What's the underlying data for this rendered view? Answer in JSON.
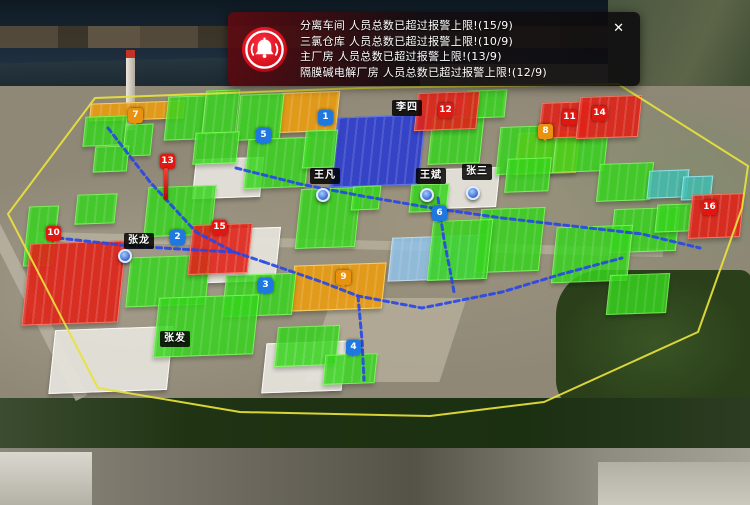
{
  "colors": {
    "building_green": "#35d41c",
    "building_green_border": "#7dff5a",
    "building_red": "#e02318",
    "building_red_border": "#ff7a66",
    "building_orange": "#e89b12",
    "building_orange_border": "#ffd36e",
    "building_darkblue": "#2336d6",
    "building_darkblue_border": "#5a74ff",
    "building_lightblue": "#8fc3ea",
    "building_lightblue_border": "#cfe8ff",
    "building_teal": "#3fbdb0",
    "building_teal_border": "#99eeff",
    "building_gray": "#e4e2da",
    "boundary_yellow": "#e8e23c",
    "route_blue": "#2746e8",
    "marker_blue": "#1f78e0",
    "marker_orange": "#e8920f",
    "marker_red": "#e01812",
    "alert_red": "#e01020"
  },
  "alert_panel": {
    "icon": "alarm-bell-icon",
    "close_label": "✕",
    "messages": [
      "分离车间 人员总数已超过报警上限!(15/9)",
      "三氯仓库 人员总数已超过报警上限!(10/9)",
      "主厂房 人员总数已超过报警上限!(13/9)",
      "隔膜碱电解厂房 人员总数已超过报警上限!(12/9)"
    ]
  },
  "map": {
    "boundary": {
      "points": "95,98 360,88 618,84 748,166 742,208 698,332 544,402 430,416 240,412 98,388 8,214"
    },
    "routes": [
      {
        "points": "108,128 150,182 196,232 234,252 264,262"
      },
      {
        "points": "58,238 130,246 196,250 234,252"
      },
      {
        "points": "236,168 300,184 362,196 432,208 502,218 572,226 642,234 700,248"
      },
      {
        "points": "438,198 444,240 450,270 454,292"
      },
      {
        "points": "264,262 322,282 358,296 422,308 502,292 562,274 622,258"
      },
      {
        "points": "358,296 362,340 364,380"
      }
    ],
    "buildings": [
      {
        "color": "orange",
        "x": 90,
        "y": 102,
        "w": 92,
        "h": 16
      },
      {
        "color": "orange",
        "x": 280,
        "y": 92,
        "w": 56,
        "h": 38
      },
      {
        "color": "orange",
        "x": 516,
        "y": 132,
        "w": 60,
        "h": 40
      },
      {
        "color": "orange",
        "x": 292,
        "y": 264,
        "w": 90,
        "h": 44
      },
      {
        "color": "darkblue",
        "x": 334,
        "y": 116,
        "w": 86,
        "h": 68
      },
      {
        "color": "lightblue",
        "x": 390,
        "y": 236,
        "w": 94,
        "h": 42
      },
      {
        "color": "gray",
        "x": 194,
        "y": 158,
        "w": 66,
        "h": 38
      },
      {
        "color": "gray",
        "x": 210,
        "y": 228,
        "w": 66,
        "h": 52
      },
      {
        "color": "gray",
        "x": 52,
        "y": 328,
        "w": 116,
        "h": 62
      },
      {
        "color": "gray",
        "x": 264,
        "y": 342,
        "w": 78,
        "h": 48
      },
      {
        "color": "gray",
        "x": 440,
        "y": 168,
        "w": 56,
        "h": 38
      },
      {
        "color": "green",
        "x": 84,
        "y": 116,
        "w": 40,
        "h": 28
      },
      {
        "color": "green",
        "x": 124,
        "y": 124,
        "w": 26,
        "h": 30
      },
      {
        "color": "green",
        "x": 166,
        "y": 96,
        "w": 36,
        "h": 42
      },
      {
        "color": "green",
        "x": 204,
        "y": 90,
        "w": 32,
        "h": 42
      },
      {
        "color": "green",
        "x": 238,
        "y": 94,
        "w": 42,
        "h": 44
      },
      {
        "color": "green",
        "x": 194,
        "y": 132,
        "w": 42,
        "h": 30
      },
      {
        "color": "green",
        "x": 246,
        "y": 138,
        "w": 60,
        "h": 48
      },
      {
        "color": "green",
        "x": 304,
        "y": 130,
        "w": 30,
        "h": 36
      },
      {
        "color": "green",
        "x": 430,
        "y": 116,
        "w": 50,
        "h": 46
      },
      {
        "color": "green",
        "x": 466,
        "y": 90,
        "w": 38,
        "h": 26
      },
      {
        "color": "green",
        "x": 498,
        "y": 126,
        "w": 56,
        "h": 46
      },
      {
        "color": "green",
        "x": 554,
        "y": 136,
        "w": 50,
        "h": 34
      },
      {
        "color": "green",
        "x": 598,
        "y": 163,
        "w": 52,
        "h": 36
      },
      {
        "color": "green",
        "x": 612,
        "y": 208,
        "w": 64,
        "h": 42
      },
      {
        "color": "green",
        "x": 554,
        "y": 226,
        "w": 74,
        "h": 54
      },
      {
        "color": "green",
        "x": 478,
        "y": 208,
        "w": 62,
        "h": 62
      },
      {
        "color": "green",
        "x": 430,
        "y": 220,
        "w": 58,
        "h": 58
      },
      {
        "color": "green",
        "x": 298,
        "y": 188,
        "w": 58,
        "h": 58
      },
      {
        "color": "green",
        "x": 146,
        "y": 186,
        "w": 66,
        "h": 48
      },
      {
        "color": "green",
        "x": 76,
        "y": 194,
        "w": 38,
        "h": 28
      },
      {
        "color": "green",
        "x": 26,
        "y": 206,
        "w": 28,
        "h": 58
      },
      {
        "color": "green",
        "x": 128,
        "y": 256,
        "w": 78,
        "h": 48
      },
      {
        "color": "green",
        "x": 224,
        "y": 274,
        "w": 68,
        "h": 40
      },
      {
        "color": "green",
        "x": 156,
        "y": 296,
        "w": 98,
        "h": 58
      },
      {
        "color": "green",
        "x": 276,
        "y": 326,
        "w": 60,
        "h": 38
      },
      {
        "color": "green",
        "x": 324,
        "y": 354,
        "w": 50,
        "h": 28
      },
      {
        "color": "green",
        "x": 608,
        "y": 274,
        "w": 58,
        "h": 38
      },
      {
        "color": "green",
        "x": 656,
        "y": 204,
        "w": 32,
        "h": 26
      },
      {
        "color": "green",
        "x": 506,
        "y": 158,
        "w": 42,
        "h": 32
      },
      {
        "color": "green",
        "x": 94,
        "y": 146,
        "w": 32,
        "h": 24
      },
      {
        "color": "green",
        "x": 352,
        "y": 186,
        "w": 26,
        "h": 22
      },
      {
        "color": "green",
        "x": 410,
        "y": 184,
        "w": 36,
        "h": 26
      },
      {
        "color": "teal",
        "x": 648,
        "y": 170,
        "w": 38,
        "h": 26
      },
      {
        "color": "teal",
        "x": 682,
        "y": 176,
        "w": 28,
        "h": 22
      },
      {
        "color": "red",
        "x": 26,
        "y": 242,
        "w": 94,
        "h": 80
      },
      {
        "color": "red",
        "x": 190,
        "y": 224,
        "w": 58,
        "h": 48
      },
      {
        "color": "red",
        "x": 416,
        "y": 92,
        "w": 60,
        "h": 36
      },
      {
        "color": "red",
        "x": 540,
        "y": 102,
        "w": 48,
        "h": 34
      },
      {
        "color": "red",
        "x": 578,
        "y": 96,
        "w": 60,
        "h": 40
      },
      {
        "color": "red",
        "x": 690,
        "y": 194,
        "w": 50,
        "h": 42
      }
    ],
    "markers": [
      {
        "n": "1",
        "type": "blue",
        "x": 318,
        "y": 110
      },
      {
        "n": "2",
        "type": "blue",
        "x": 170,
        "y": 230
      },
      {
        "n": "3",
        "type": "blue",
        "x": 258,
        "y": 278
      },
      {
        "n": "4",
        "type": "blue",
        "x": 346,
        "y": 340
      },
      {
        "n": "5",
        "type": "blue",
        "x": 256,
        "y": 128
      },
      {
        "n": "6",
        "type": "blue",
        "x": 432,
        "y": 206
      },
      {
        "n": "7",
        "type": "orange",
        "x": 128,
        "y": 108
      },
      {
        "n": "8",
        "type": "orange",
        "x": 538,
        "y": 124
      },
      {
        "n": "9",
        "type": "orange",
        "x": 336,
        "y": 270
      },
      {
        "n": "10",
        "type": "red",
        "x": 46,
        "y": 226
      },
      {
        "n": "11",
        "type": "red",
        "x": 562,
        "y": 110
      },
      {
        "n": "12",
        "type": "red",
        "x": 438,
        "y": 103
      },
      {
        "n": "13",
        "type": "red",
        "x": 160,
        "y": 154
      },
      {
        "n": "14",
        "type": "red",
        "x": 592,
        "y": 106
      },
      {
        "n": "15",
        "type": "red",
        "x": 212,
        "y": 220
      },
      {
        "n": "16",
        "type": "red",
        "x": 702,
        "y": 200
      }
    ],
    "persons": [
      {
        "name": "李四",
        "x": 392,
        "y": 100
      },
      {
        "name": "王凡",
        "x": 310,
        "y": 168
      },
      {
        "name": "王斌",
        "x": 416,
        "y": 168
      },
      {
        "name": "张三",
        "x": 462,
        "y": 164
      },
      {
        "name": "张龙",
        "x": 124,
        "y": 233
      },
      {
        "name": "张发",
        "x": 160,
        "y": 331
      }
    ],
    "pins": [
      {
        "color": "blue",
        "x": 420,
        "y": 188
      },
      {
        "color": "blue",
        "x": 466,
        "y": 186
      },
      {
        "color": "blue",
        "x": 118,
        "y": 249
      },
      {
        "color": "blue",
        "x": 316,
        "y": 188
      },
      {
        "color": "red",
        "x": 164,
        "y": 168
      }
    ]
  }
}
